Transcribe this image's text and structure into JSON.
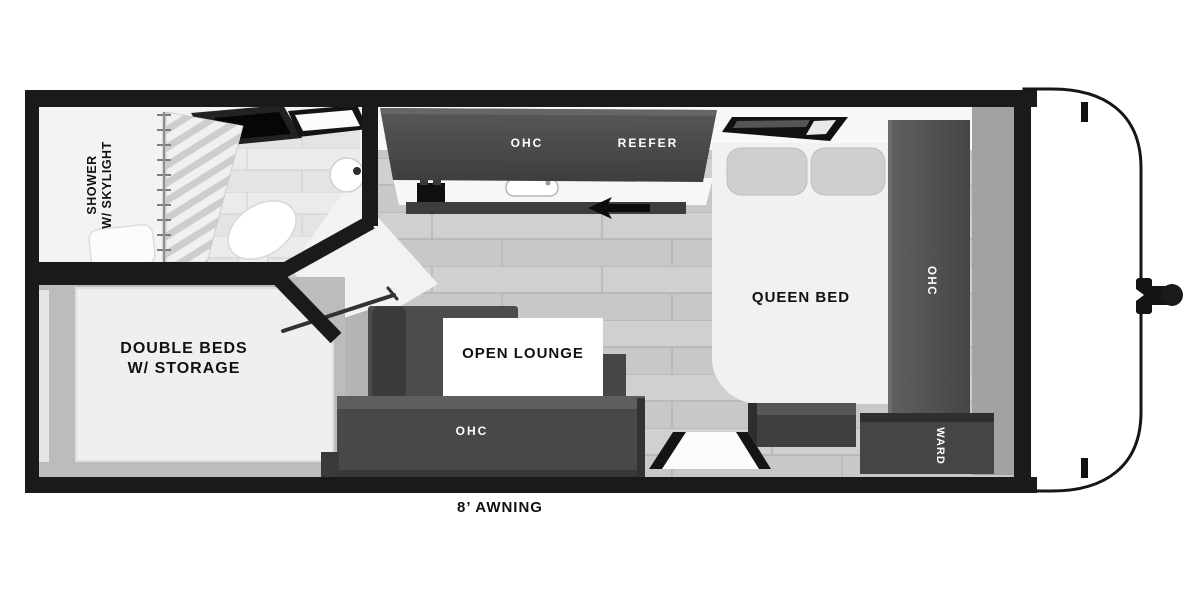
{
  "floorplan": {
    "labels": {
      "shower_line1": "SHOWER",
      "shower_line2": "W/ SKYLIGHT",
      "ohc_kitchen": "OHC",
      "reefer": "REEFER",
      "queen_bed": "QUEEN BED",
      "ohc_bedroom": "OHC",
      "ward": "WARD",
      "double_beds_line1": "DOUBLE BEDS",
      "double_beds_line2": "W/ STORAGE",
      "open_lounge": "OPEN LOUNGE",
      "ohc_lounge": "OHC",
      "awning": "8’ AWNING"
    },
    "colors": {
      "wall": "#1a1a1a",
      "cabinet_dark": "#4a4a4a",
      "floor_gray": "#c9c9c9",
      "mattress_white": "#f1f1f1",
      "background": "#ffffff",
      "label_dark": "#111111",
      "label_light": "#ffffff"
    }
  }
}
